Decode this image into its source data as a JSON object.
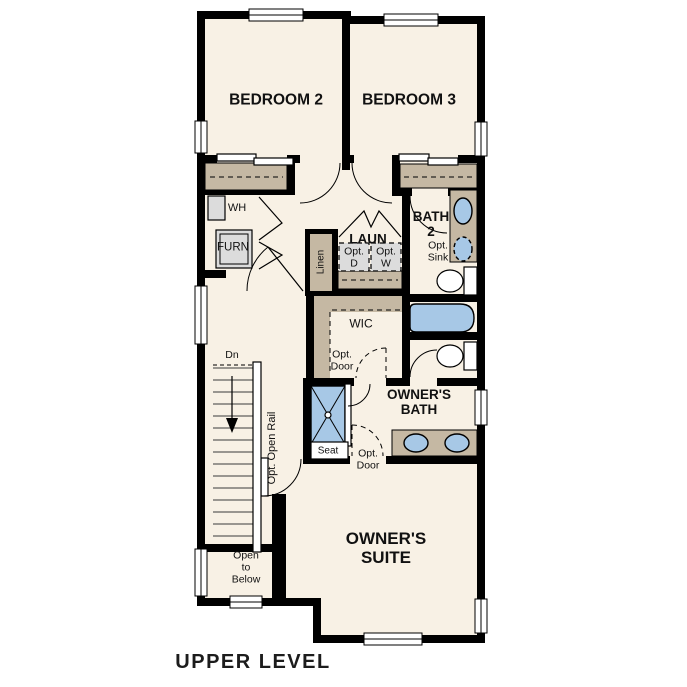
{
  "labels": {
    "bedroom2": "BEDROOM 2",
    "bedroom3": "BEDROOM 3",
    "water_heater": "WH",
    "furnace": "FURN",
    "laundry": "LAUN",
    "opt_dryer": "Opt.\nD",
    "opt_washer": "Opt.\nW",
    "linen": "Linen",
    "bath2": "BATH\n2",
    "opt_sink": "Opt.\nSink",
    "wic": "WIC",
    "wic_opt_door": "Opt.\nDoor",
    "stairs_down": "Dn",
    "opt_open_rail": "Opt. Open Rail",
    "open_to_below": "Open\nto\nBelow",
    "owners_bath": "OWNER'S\nBATH",
    "shower_seat": "Seat",
    "bath_opt_door": "Opt.\nDoor",
    "owners_suite": "OWNER'S\nSUITE",
    "level_title": "UPPER LEVEL"
  },
  "colors": {
    "wall": "#000000",
    "floor": "#f8f1e5",
    "casework": "#c5b8a3",
    "fixture": "#a7c8e6",
    "appliance": "#dcdcdc"
  }
}
